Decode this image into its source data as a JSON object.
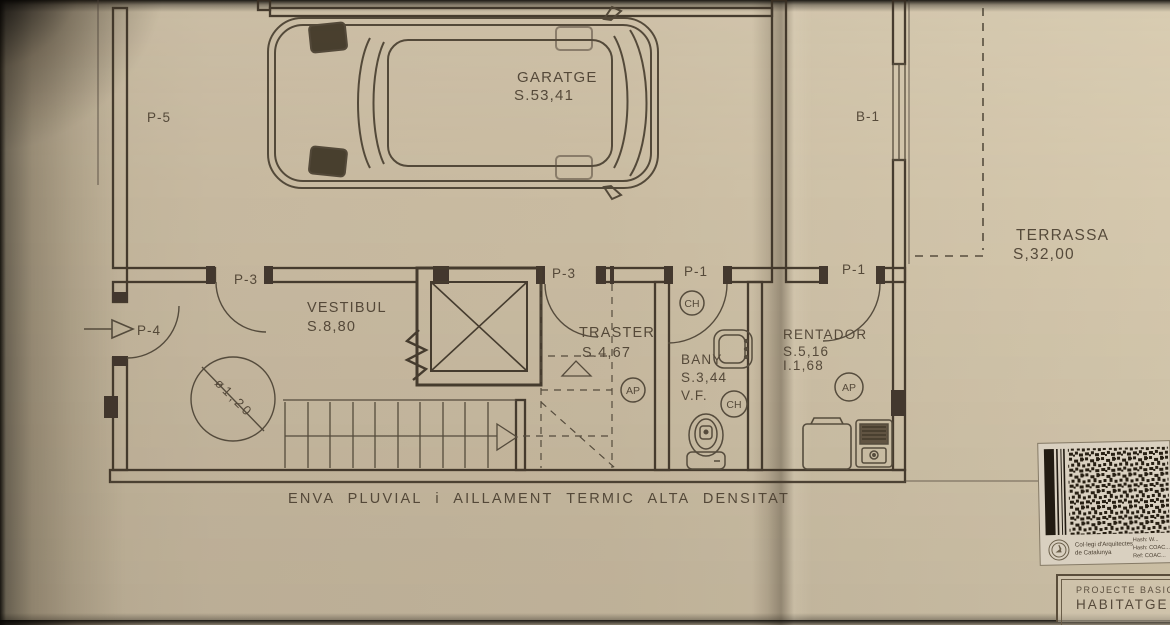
{
  "colors": {
    "paper": "#c8baa1",
    "ink": "#483d2f",
    "wall": "#382f23"
  },
  "plan": {
    "rooms": {
      "garatge": {
        "name": "GARATGE",
        "area": "S.53,41"
      },
      "terrassa": {
        "name": "TERRASSA",
        "area": "S,32,00"
      },
      "vestibul": {
        "name": "VESTIBUL",
        "area": "S.8,80"
      },
      "traster": {
        "name": "TRASTER",
        "area": "S.4,67"
      },
      "bany": {
        "name": "BANY",
        "area": "S.3,44",
        "vent": "V.F."
      },
      "rentador": {
        "name": "RENTADOR",
        "area": "S.5,16",
        "extra": "I.1,68"
      }
    },
    "openings": {
      "p5": "P-5",
      "p4": "P-4",
      "p3a": "P-3",
      "p3b": "P-3",
      "p1a": "P-1",
      "p1b": "P-1",
      "b1": "B-1"
    },
    "symbols": {
      "ch": "CH",
      "ap": "AP",
      "diameter": "ø1,20"
    },
    "footer_note": "ENVA PLUVIAL i AILLAMENT TERMIC ALTA DENSITAT"
  },
  "stamp": {
    "org_line1": "Col·legi d'Arquitectes",
    "org_line2": "de Catalunya",
    "meta_line1": "Hash: W...",
    "meta_line2": "Hash: COAC...",
    "meta_line3": "Ref: COAC..."
  },
  "title_block": {
    "line1": "PROJECTE BASIC",
    "line2": "HABITATGE U"
  }
}
